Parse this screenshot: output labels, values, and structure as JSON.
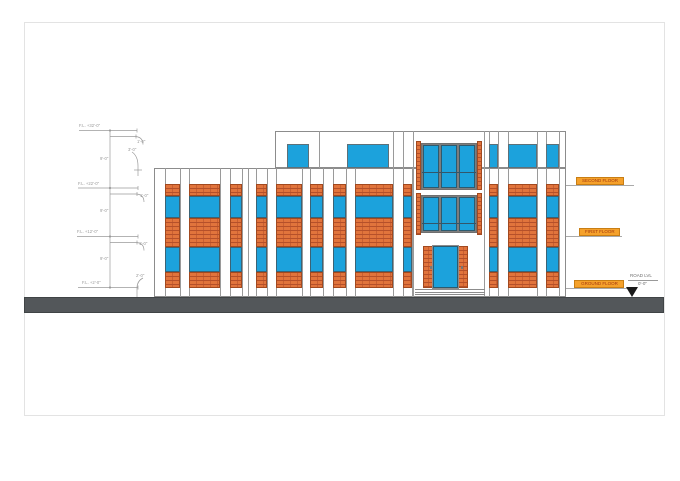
{
  "drawing_texts": {
    "levels": [
      {
        "label": "F.L. +32'-0\""
      },
      {
        "label": "F.L. +22'-0\""
      },
      {
        "label": "F.L. +12'-0\""
      },
      {
        "label": "F.L. +2'-0\""
      }
    ],
    "story_height": "9'-0\"",
    "slab_offset": "1'-0\"",
    "parapet_offset": "3'-0\"",
    "plinth_offset": "2'-0\"",
    "floor_tags": [
      {
        "label": "SECOND FLOOR"
      },
      {
        "label": "FIRST FLOOR"
      },
      {
        "label": "GROUND FLOOR"
      }
    ],
    "road": {
      "label": "ROAD LVL",
      "level": "0'-0\""
    }
  },
  "colors": {
    "glass_blue": "#1CA2DC",
    "brick_orange": "#E1743C",
    "brick_joint": "#B5502A",
    "ground_gray": "#53575A",
    "tag_background": "#F5A12B",
    "tag_text": "#A3380E",
    "line_gray": "#8C8C8C"
  }
}
